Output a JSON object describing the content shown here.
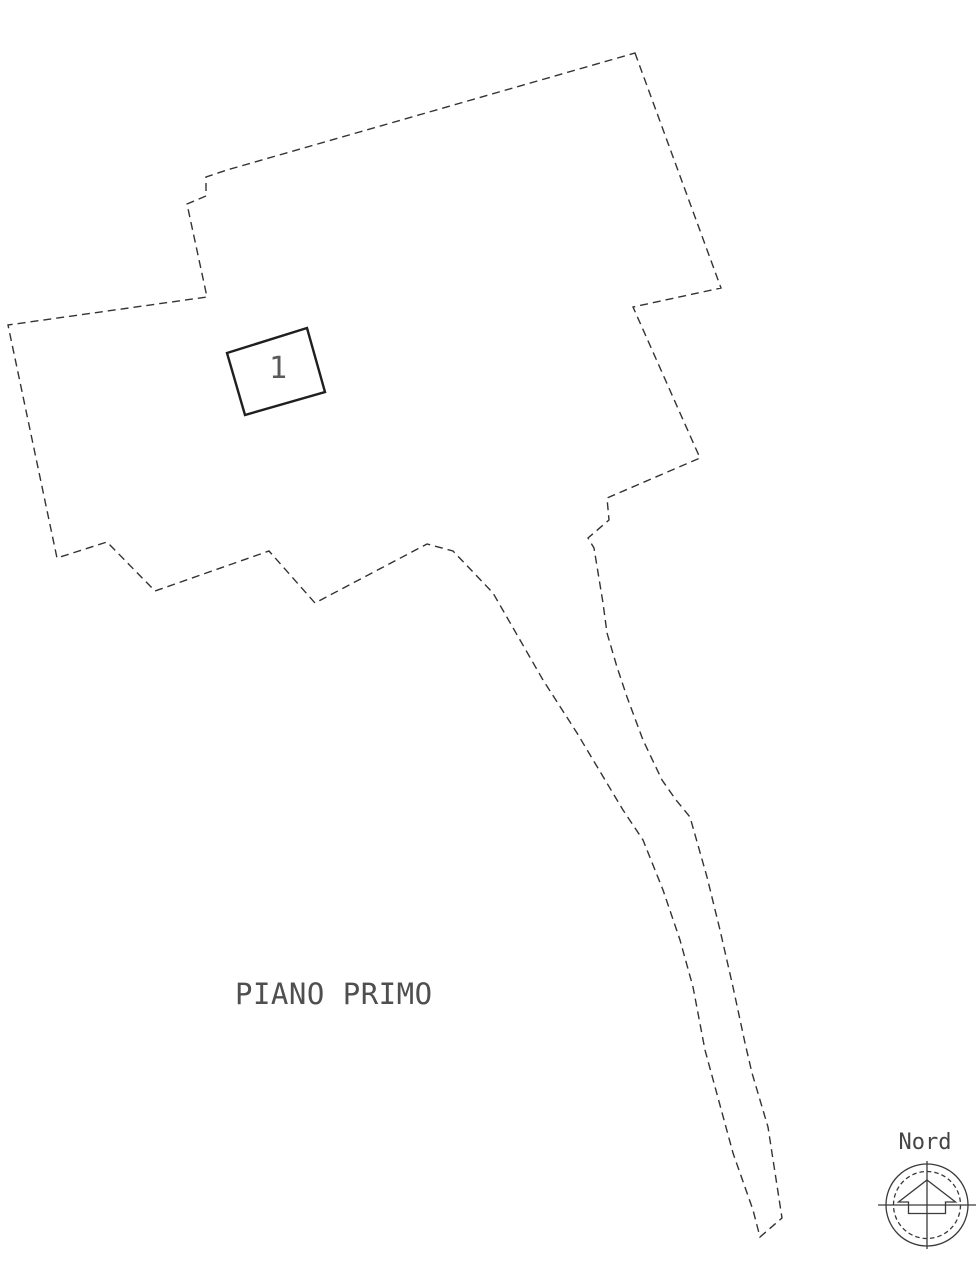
{
  "colors": {
    "background": "#ffffff",
    "boundary_line": "#333333",
    "unit_outline": "#1f1f1f",
    "text": "#4f4f4f",
    "compass_line": "#3a3a3a"
  },
  "floor_plan": {
    "title": "PIANO PRIMO",
    "title_position": {
      "x": 235,
      "y": 1004
    },
    "unit_number": "1",
    "unit_label_position": {
      "x": 278,
      "y": 378
    },
    "boundary_dash": "8 5",
    "boundary_points": [
      [
        635,
        53
      ],
      [
        721,
        288
      ],
      [
        633,
        307
      ],
      [
        700,
        458
      ],
      [
        607,
        498
      ],
      [
        609,
        520
      ],
      [
        588,
        538
      ],
      [
        594,
        548
      ],
      [
        603,
        603
      ],
      [
        607,
        633
      ],
      [
        617,
        667
      ],
      [
        627,
        697
      ],
      [
        643,
        740
      ],
      [
        662,
        780
      ],
      [
        676,
        800
      ],
      [
        690,
        817
      ],
      [
        707,
        877
      ],
      [
        720,
        930
      ],
      [
        733,
        987
      ],
      [
        745,
        1043
      ],
      [
        752,
        1073
      ],
      [
        768,
        1127
      ],
      [
        782,
        1218
      ],
      [
        760,
        1237
      ],
      [
        753,
        1210
      ],
      [
        733,
        1153
      ],
      [
        705,
        1050
      ],
      [
        693,
        987
      ],
      [
        680,
        940
      ],
      [
        663,
        890
      ],
      [
        643,
        840
      ],
      [
        623,
        810
      ],
      [
        577,
        733
      ],
      [
        543,
        680
      ],
      [
        493,
        593
      ],
      [
        453,
        551
      ],
      [
        427,
        544
      ],
      [
        315,
        603
      ],
      [
        269,
        551
      ],
      [
        155,
        591
      ],
      [
        107,
        542
      ],
      [
        57,
        558
      ],
      [
        8,
        325
      ],
      [
        207,
        297
      ],
      [
        187,
        204
      ],
      [
        206,
        196
      ],
      [
        206,
        177
      ],
      [
        227,
        170
      ]
    ],
    "unit_rect_points": [
      [
        227,
        353
      ],
      [
        307,
        328
      ],
      [
        325,
        392
      ],
      [
        245,
        415
      ]
    ]
  },
  "compass": {
    "label": "Nord",
    "label_position": {
      "x": 925,
      "y": 1149
    },
    "center": {
      "x": 927,
      "y": 1205
    },
    "outer_radius": 41,
    "inner_radius": 33.5,
    "horizontal_axis": {
      "x1": 878,
      "x2": 976
    },
    "vertical_axis": {
      "y1": 1161,
      "y2": 1249
    },
    "arrow": {
      "apex_rise": 25,
      "roof_half_width": 28.5,
      "shoulder_half_width": 18.5,
      "roof_base_drop": -3,
      "foot_drop": 8.5
    }
  }
}
